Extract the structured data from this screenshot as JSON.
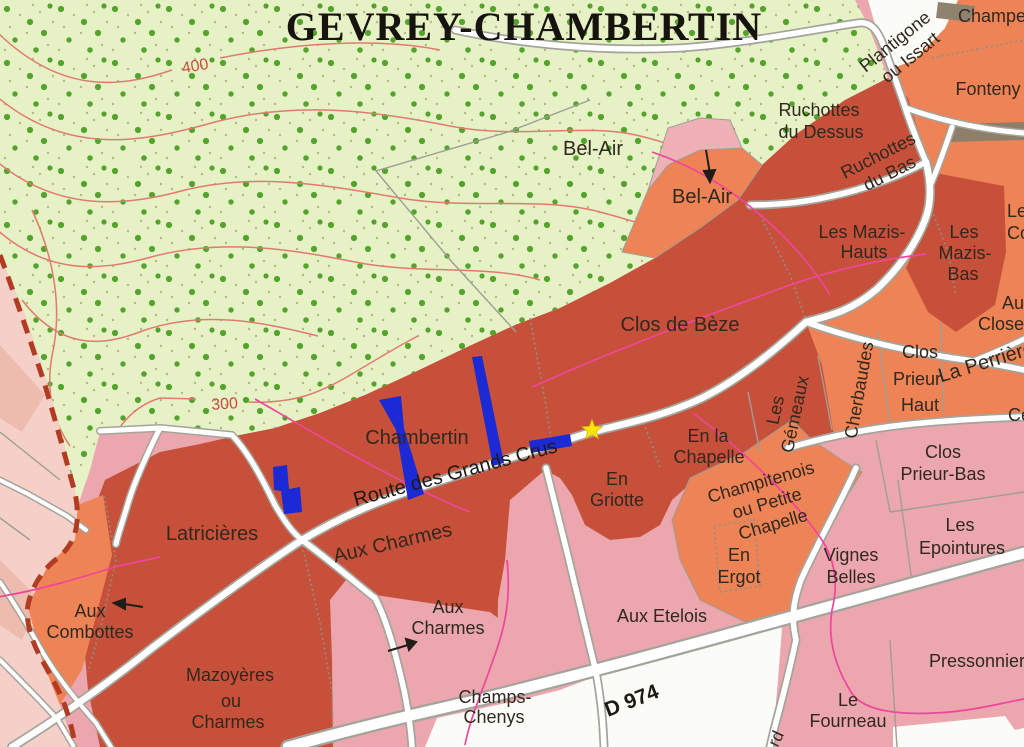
{
  "title": "GEVREY-CHAMBERTIN",
  "colors": {
    "grand_cru_red": "#c7503a",
    "premier_cru_orange": "#ee8355",
    "village_pink": "#eba6ae",
    "pale_zone": "#f4d0c9",
    "forest_green": "#e6f1c6",
    "forest_dot_green": "#55a32c",
    "contour_red": "#e27a6f",
    "magenta_path": "#f0459b",
    "boundary_dash": "#b23c22",
    "road_white": "#ffffff",
    "road_casing": "#a5a49c",
    "marker_blue": "#1b2ad4",
    "star_yellow": "#ffe20d",
    "brown_patch": "#8e7f6a"
  },
  "contour_labels": {
    "l400": "400",
    "l300": "300"
  },
  "roads": {
    "grands_crus": "Route des Grands Crus",
    "d974": "D 974",
    "fragment": "rd"
  },
  "vineyards": {
    "bel_air_forest": {
      "label": "Bel-Air"
    },
    "bel_air_parcel": {
      "label": "Bel-Air"
    },
    "ruchottes_dessus": {
      "lines": [
        "Ruchottes",
        "du Dessus"
      ]
    },
    "ruchottes_bas": {
      "lines": [
        "Ruchottes",
        "du Bas"
      ]
    },
    "plantigone": {
      "lines": [
        "Plantigone",
        "ou Issart"
      ]
    },
    "champeaux": {
      "label": "Champe"
    },
    "fonteny": {
      "label": "Fonteny"
    },
    "mazis_hauts": {
      "lines": [
        "Les Mazis-",
        "Hauts"
      ]
    },
    "mazis_bas": {
      "lines": [
        "Les",
        "Mazis-",
        "Bas"
      ]
    },
    "corbeaux": {
      "lines": [
        "Les",
        "Co"
      ]
    },
    "clos_de_beze": {
      "label": "Clos de Bèze"
    },
    "closeau": {
      "lines": [
        "Au",
        "Close"
      ]
    },
    "clos_prieur_haut": {
      "lines": [
        "Clos",
        "Prieur-",
        "Haut"
      ]
    },
    "la_perriere": {
      "label": "La Perrière"
    },
    "cercueils": {
      "label": "Ce"
    },
    "gemeaux": {
      "lines": [
        "Les",
        "Gémeaux"
      ]
    },
    "cherbaudes": {
      "label": "Cherbaudes"
    },
    "chambertin": {
      "label": "Chambertin"
    },
    "en_la_chapelle": {
      "lines": [
        "En la",
        "Chapelle"
      ]
    },
    "en_griotte": {
      "lines": [
        "En",
        "Griotte"
      ]
    },
    "champitenois": {
      "lines": [
        "Champitenois",
        "ou Petite",
        "Chapelle"
      ]
    },
    "en_ergot": {
      "lines": [
        "En",
        "Ergot"
      ]
    },
    "vignes_belles": {
      "lines": [
        "Vignes",
        "Belles"
      ]
    },
    "clos_prieur_bas": {
      "lines": [
        "Clos",
        "Prieur-Bas"
      ]
    },
    "epointures": {
      "lines": [
        "Les",
        "Epointures"
      ]
    },
    "pressonnier": {
      "label": "Pressonnier"
    },
    "le_fourneau": {
      "lines": [
        "Le",
        "Fourneau"
      ]
    },
    "aux_etelois": {
      "label": "Aux Etelois"
    },
    "champs_chenys": {
      "lines": [
        "Champs-",
        "Chenys"
      ]
    },
    "aux_charmes_road": {
      "label": "Aux Charmes"
    },
    "aux_charmes_parcel": {
      "lines": [
        "Aux",
        "Charmes"
      ]
    },
    "latricieres": {
      "label": "Latricières"
    },
    "aux_combottes": {
      "lines": [
        "Aux",
        "Combottes"
      ]
    },
    "mazoyeres": {
      "lines": [
        "Mazoyères",
        "ou",
        "Charmes"
      ]
    }
  }
}
